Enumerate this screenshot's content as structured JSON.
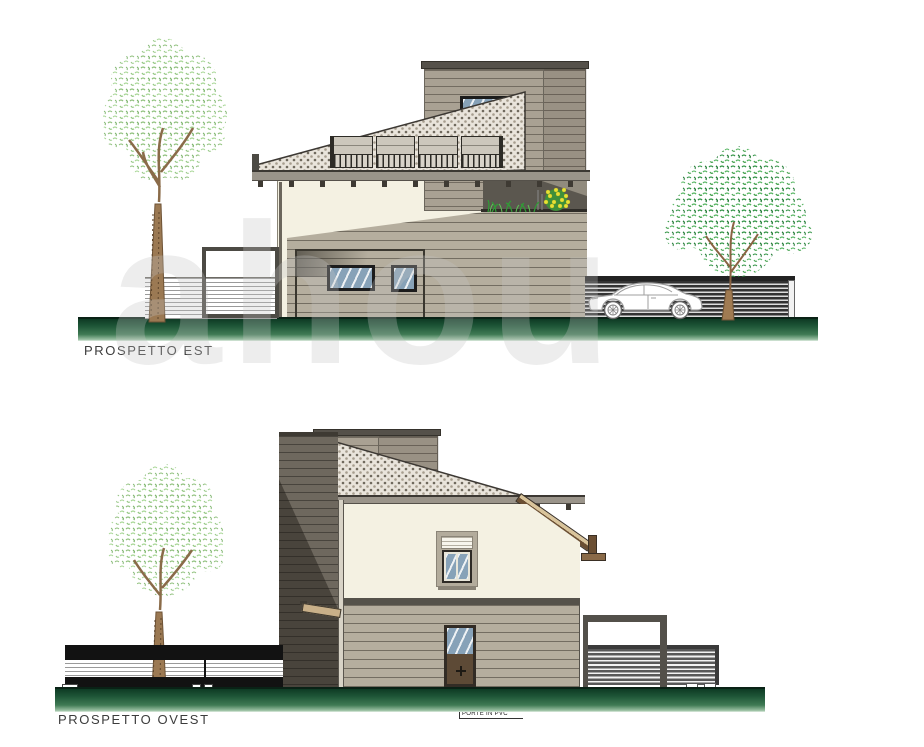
{
  "document": {
    "type": "architectural elevation drawing",
    "background": "#ffffff"
  },
  "watermark": {
    "text": "ahou"
  },
  "elevations": {
    "est": {
      "label": "PROSPETTO EST",
      "objects": [
        "deciduous-tree-light",
        "slat-fence-white",
        "gate-frame",
        "mono-pitch-roof-tiled",
        "roof-terrace-railing",
        "upper-volume-siding",
        "small-window",
        "cream-wall",
        "lower-volume-siding",
        "porch-recess",
        "window-large",
        "window-small",
        "terrace-planter-with-yellow-flowers",
        "slat-fence-dark",
        "parked-car",
        "deciduous-tree-dark",
        "ground-strip"
      ]
    },
    "ovest": {
      "label": "PROSPETTO OVEST",
      "annotation": "PORTE IN PVC",
      "objects": [
        "deciduous-tree-light",
        "slat-fence-black",
        "dark-side-volume",
        "mono-pitch-roof-tiled",
        "upper-volume-siding",
        "eave-bracket-wood",
        "cream-wall",
        "shuttered-window",
        "pvc-door",
        "pergola-frame",
        "slat-fence-gray",
        "ground-strip"
      ]
    }
  },
  "palette": {
    "ground_green_dark": "#0e3a24",
    "ground_green_mid": "#3f7a54",
    "wall_cream": "#f4f1e2",
    "siding_taupe": "#b5ae9e",
    "siding_tower": "#a9a193",
    "dark_volume": "#6e685e",
    "roof_stipple_base": "#e9e4db",
    "roof_stipple_dot": "#6f695d",
    "glass_blue": "#87a2b8",
    "foliage_light": "#8fc07c",
    "foliage_dark": "#2f9243",
    "trunk_brown": "#9b7953",
    "wood_eave": "#6b4f33",
    "flower_yellow": "#e6e137",
    "label_text": "#3c3c3c"
  }
}
